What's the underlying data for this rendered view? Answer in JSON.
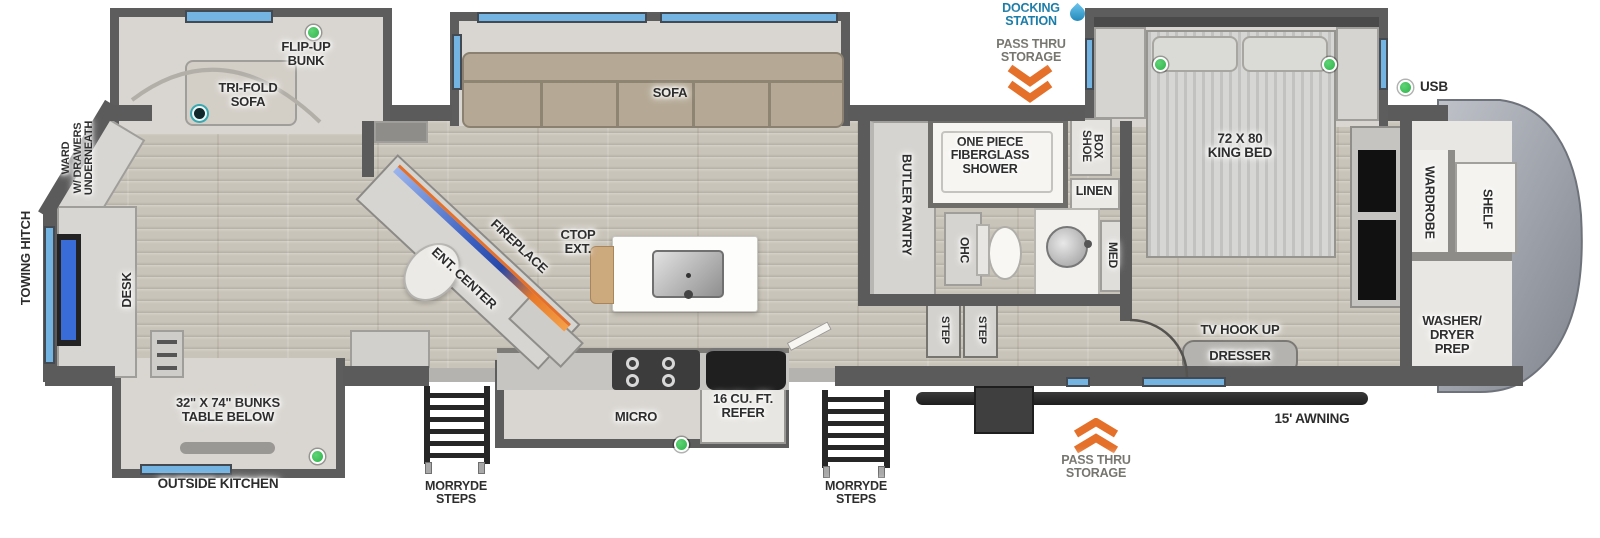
{
  "floorplan": {
    "rear": {
      "towing_hitch": "TOWING HITCH",
      "ward": "WARD\nW/ DRAWERS\nUNDERNEATH",
      "desk": "DESK",
      "flip_up_bunk": "FLIP-UP\nBUNK",
      "tri_fold_sofa": "TRI-FOLD\nSOFA",
      "bunks": "32\" X 74\" BUNKS\nTABLE BELOW",
      "outside_kitchen": "OUTSIDE KITCHEN",
      "morryde_steps": "MORRYDE\nSTEPS"
    },
    "living": {
      "sofa": "SOFA",
      "fireplace": "FIREPLACE",
      "ent_center": "ENT. CENTER",
      "ctop_ext": "CTOP\nEXT."
    },
    "kitchen": {
      "micro": "MICRO",
      "refer": "16 CU. FT.\nREFER",
      "morryde_steps": "MORRYDE\nSTEPS"
    },
    "bath": {
      "butler_pantry": "BUTLER PANTRY",
      "ohc": "OHC",
      "step_left": "STEP",
      "step_right": "STEP",
      "shower": "ONE PIECE\nFIBERGLASS\nSHOWER",
      "shoe_box": "SHOE\nBOX",
      "linen": "LINEN",
      "med": "MED"
    },
    "bedroom": {
      "king_bed": "72 X 80\nKING BED",
      "tv_hook_up": "TV HOOK UP",
      "dresser": "DRESSER",
      "usb": "USB"
    },
    "front": {
      "wardrobe": "WARDROBE",
      "shelf": "SHELF",
      "washer_dryer_prep": "WASHER/\nDRYER\nPREP"
    },
    "exterior": {
      "docking_station": "DOCKING\nSTATION",
      "pass_thru_storage_top": "PASS THRU\nSTORAGE",
      "pass_thru_storage_bottom": "PASS THRU\nSTORAGE",
      "awning": "15' AWNING"
    }
  },
  "colors": {
    "wall": "#5b5b5b",
    "floor_wood": "#c9c4b9",
    "slide_floor": "#d9d6d1",
    "window_blue": "#74b4e2",
    "indicator_green": "#2eb34a",
    "accent_orange": "#e4702a",
    "docking_blue": "#1a7ca8",
    "awning_black": "#1e1e1e"
  }
}
